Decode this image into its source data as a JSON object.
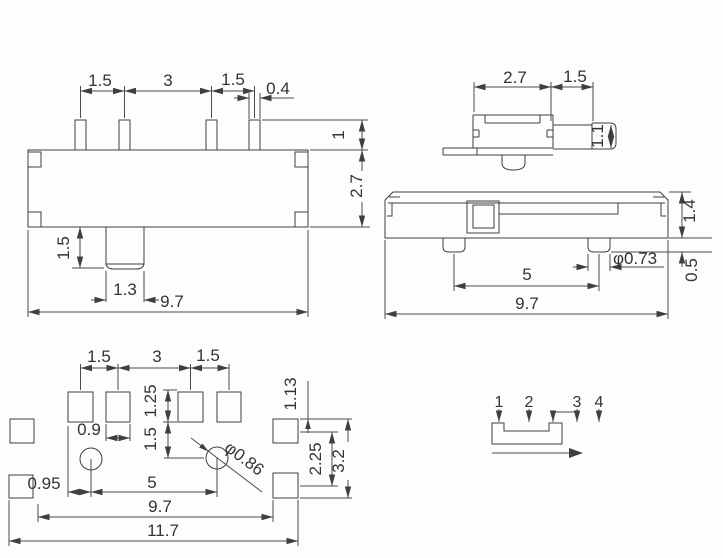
{
  "front_view": {
    "pitch_1": "1.5",
    "pitch_2": "3",
    "pitch_3": "1.5",
    "pin_width": "0.4",
    "pin_height": "1",
    "body_height": "2.7",
    "knob_height": "1.5",
    "knob_width": "1.3",
    "body_width": "9.7"
  },
  "end_view": {
    "body_width": "2.7",
    "knob_travel": "1.5",
    "knob_height": "1.1"
  },
  "side_view": {
    "body_height": "1.4",
    "post_height": "0.5",
    "post_pitch": "5",
    "post_diameter": "φ0.73",
    "body_length": "9.7"
  },
  "footprint_view": {
    "pitch_1": "1.5",
    "pitch_2": "3",
    "pitch_3": "1.5",
    "pad_width": "0.9",
    "pad_height": "1.25",
    "pad_to_hole": "1.5",
    "side_pad_offset": "1.13",
    "side_pad_gap": "2.25",
    "side_pad_span": "3.2",
    "hole_diameter": "φ0.86",
    "edge_to_hole": "0.95",
    "hole_pitch": "5",
    "body_length": "9.7",
    "total_length": "11.7"
  },
  "schematic": {
    "pin_labels": [
      "1",
      "2",
      "3",
      "4"
    ]
  }
}
